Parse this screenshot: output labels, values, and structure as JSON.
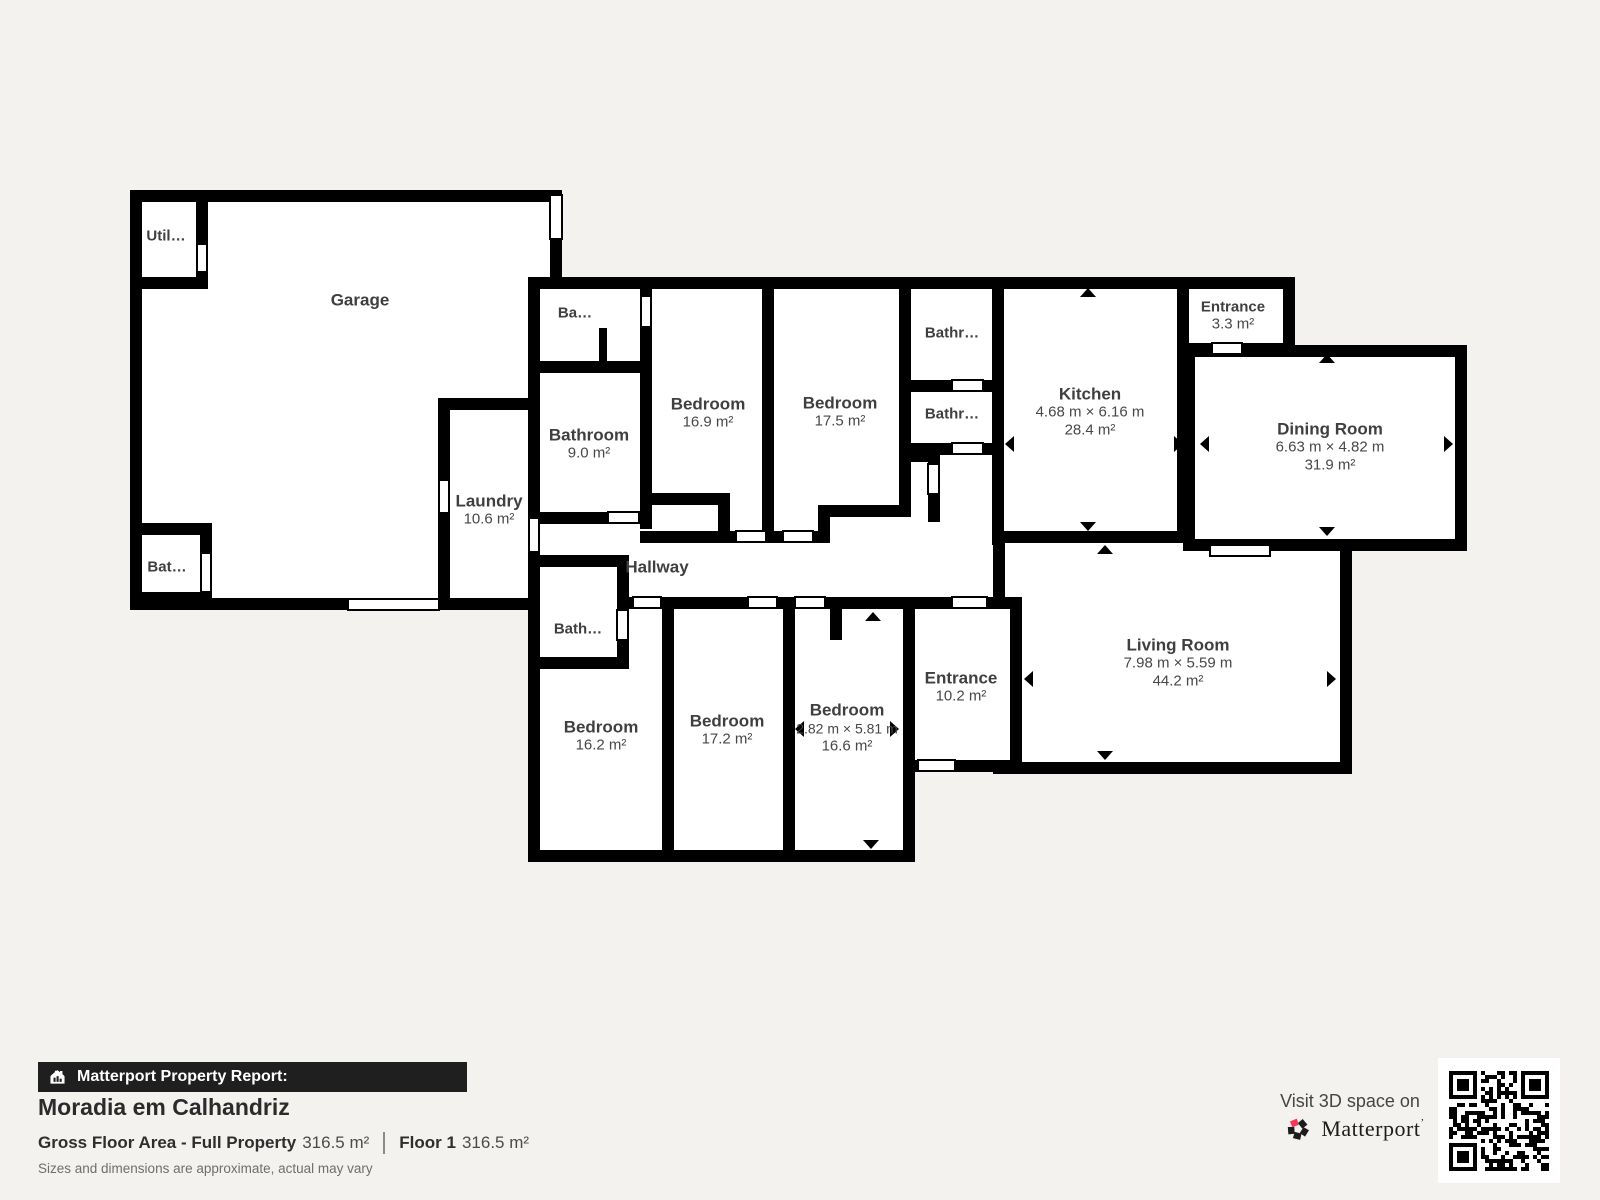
{
  "colors": {
    "background": "#f4f2ef",
    "wall": "#000000",
    "room_fill": "#ffffff",
    "label_text": "#3f3f3f",
    "footer_bar": "#1f1f1f",
    "accent_red": "#f8365a"
  },
  "rooms": {
    "util": {
      "name": "Util…"
    },
    "garage": {
      "name": "Garage"
    },
    "bat": {
      "name": "Bat…"
    },
    "laundry": {
      "name": "Laundry",
      "area": "10.6 m²"
    },
    "ba": {
      "name": "Ba…"
    },
    "bathroom": {
      "name": "Bathroom",
      "area": "9.0 m²"
    },
    "bedroom_169": {
      "name": "Bedroom",
      "area": "16.9 m²"
    },
    "bedroom_175": {
      "name": "Bedroom",
      "area": "17.5 m²"
    },
    "bathr_1": {
      "name": "Bathr…"
    },
    "bathr_2": {
      "name": "Bathr…"
    },
    "kitchen": {
      "name": "Kitchen",
      "dims": "4.68 m × 6.16 m",
      "area": "28.4 m²"
    },
    "entrance_33": {
      "name": "Entrance",
      "area": "3.3 m²"
    },
    "dining": {
      "name": "Dining Room",
      "dims": "6.63 m × 4.82 m",
      "area": "31.9 m²"
    },
    "hallway": {
      "name": "Hallway"
    },
    "bath_s": {
      "name": "Bath…"
    },
    "bedroom_162": {
      "name": "Bedroom",
      "area": "16.2 m²"
    },
    "bedroom_172": {
      "name": "Bedroom",
      "area": "17.2 m²"
    },
    "bedroom_166": {
      "name": "Bedroom",
      "dims": "2.82 m × 5.81 m",
      "area": "16.6 m²"
    },
    "entrance_102": {
      "name": "Entrance",
      "area": "10.2 m²"
    },
    "living": {
      "name": "Living Room",
      "dims": "7.98 m × 5.59 m",
      "area": "44.2 m²"
    }
  },
  "footer": {
    "report_label": "Matterport Property Report:",
    "property_name": "Moradia em Calhandriz",
    "gfa_label": "Gross Floor Area - Full Property",
    "gfa_value": "316.5 m²",
    "floor_label": "Floor 1",
    "floor_value": "316.5 m²",
    "disclaimer": "Sizes and dimensions are approximate, actual may vary"
  },
  "cta": {
    "visit": "Visit 3D space on",
    "brand": "Matterport",
    "brand_mark": "’"
  }
}
